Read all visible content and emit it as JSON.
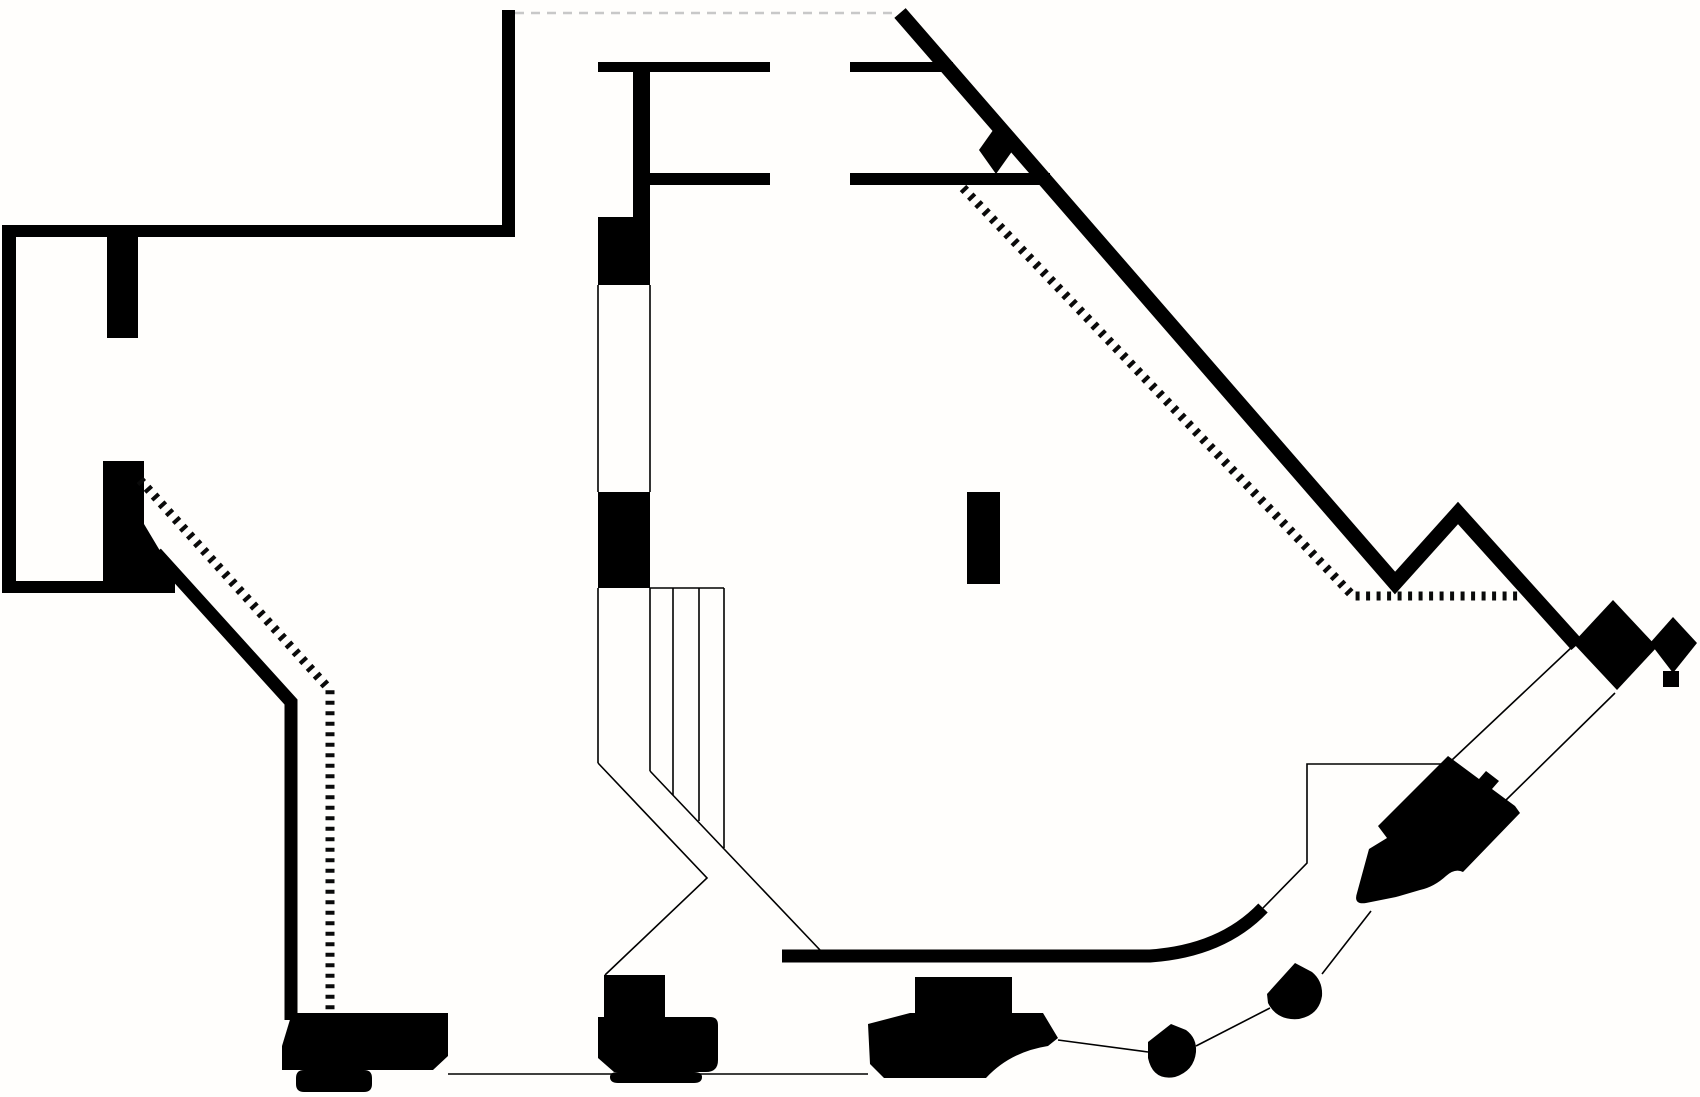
{
  "meta": {
    "title": "architectural-floor-plan",
    "canvas": {
      "width": 1700,
      "height": 1097
    },
    "colors": {
      "background": "#fffefc",
      "ink": "#000000",
      "dashed_gray": "#c8c8c8"
    }
  },
  "plan": {
    "groups": [
      {
        "name": "filled-walls-and-piers",
        "attrs": {
          "fill": "#000000",
          "stroke": "none"
        },
        "items": [
          {
            "name": "wall-top-vertical",
            "d": "M502,10 H515 V237 H502 Z"
          },
          {
            "name": "wall-upper-horizontal",
            "d": "M2,225 H515 V237 H2 Z"
          },
          {
            "name": "wall-left-vertical",
            "d": "M2,225 H16 V593 H2 Z"
          },
          {
            "name": "wall-lower-left-horizontal",
            "d": "M2,581 H175 V593 H2 Z"
          },
          {
            "name": "pier-upper-left",
            "d": "M107,237 H138 V338 H107 Z"
          },
          {
            "name": "pier-lower-left",
            "d": "M103,461 H144 V581 H103 Z"
          },
          {
            "name": "pier-lower-left-wedge",
            "d": "M144,524 L178,581 L144,581 Z"
          },
          {
            "name": "f-wall-stem",
            "d": "M633,62 H650 V217 H633 Z"
          },
          {
            "name": "f-wall-arm-top-left",
            "d": "M598,62 H770 V72 H598 Z"
          },
          {
            "name": "f-wall-arm-top-right",
            "d": "M850,62 H953 V72 H850 Z"
          },
          {
            "name": "f-wall-arm-mid-left",
            "d": "M633,173 H770 V185 H633 Z"
          },
          {
            "name": "f-wall-arm-mid-right",
            "d": "M850,173 H1050 V185 H850 Z"
          },
          {
            "name": "column-pier-upper",
            "d": "M598,217 H650 V285 H598 Z"
          },
          {
            "name": "column-pier-lower",
            "d": "M598,492 H650 V588 H598 Z"
          },
          {
            "name": "free-standing-column",
            "d": "M967,492 H1000 V584 H967 Z"
          },
          {
            "name": "diamond-on-diagonal-wall",
            "d": "M979,150 L996,126 L1013,150 L996,174 Z"
          },
          {
            "name": "cluster-large-diamond",
            "d": "M1573,643 L1613,600 L1657,647 L1617,690 Z"
          },
          {
            "name": "cluster-small-diamond",
            "d": "M1650,643 L1673,617 L1697,643 L1673,673 Z"
          },
          {
            "name": "cluster-foot-square",
            "d": "M1663,671 H1679 V687 H1663 Z"
          },
          {
            "name": "console-right-piano",
            "d": "M1448,756 L1479,779 L1486,771 L1499,781 L1492,789 L1515,806 L1520,813 L1463,872 Q1455,868 1446,876 Q1434,887 1420,890 L1396,897 L1366,903 Q1353,905 1357,893 L1369,849 L1387,838 L1378,826 L1401,803 Z"
          },
          {
            "name": "pier-bottom-2-block",
            "d": "M604,975 H665 V1017 H604 Z"
          },
          {
            "name": "console-bottom-left",
            "d": "M292,1013 L448,1013 L448,1056 L433,1070 L282,1070 L282,1046 Z"
          },
          {
            "name": "console-bottom-left-tab",
            "d": "M304,1070 H364 Q372,1070 372,1078 V1084 Q372,1092 364,1092 H304 Q296,1092 296,1084 V1078 Q296,1070 304,1070 Z"
          },
          {
            "name": "console-bottom-2",
            "d": "M598,1017 H710 Q718,1017 718,1025 V1060 Q718,1072 706,1072 H614 L598,1058 Z"
          },
          {
            "name": "console-bottom-2-tab",
            "d": "M618,1072 H694 Q702,1072 702,1077 Q702,1083 694,1083 H618 Q610,1083 610,1077 Q610,1072 618,1072 Z"
          },
          {
            "name": "pier-bottom-3-block",
            "d": "M915,977 H1012 V1013 H915 Z"
          },
          {
            "name": "console-bottom-3",
            "d": "M868,1024 L910,1013 H1043 L1058,1038 L1048,1046 Q1010,1052 986,1078 H884 L870,1064 Z"
          },
          {
            "name": "blob-stool-1",
            "d": "M1148,1042 L1171,1024 L1186,1030 Q1197,1038 1196,1052 Q1194,1071 1175,1077 Q1153,1081 1148,1058 Z"
          },
          {
            "name": "blob-stool-2",
            "d": "M1267,994 L1295,963 L1312,972 Q1323,981 1322,996 Q1319,1015 1299,1019 Q1277,1021 1268,1003 Z"
          }
        ]
      },
      {
        "name": "thick-stroke-walls",
        "attrs": {
          "fill": "none",
          "stroke": "#000000",
          "stroke-linecap": "butt",
          "stroke-linejoin": "miter"
        },
        "items": [
          {
            "name": "main-diagonal-wall",
            "d": "M900,13 L1395,583 L1458,513 L1577,645",
            "attrs": {
              "stroke-width": "15"
            }
          },
          {
            "name": "left-diagonal-wall",
            "d": "M156,553 L291,702 V1020",
            "attrs": {
              "stroke-width": "13"
            }
          },
          {
            "name": "bottom-curved-wall",
            "d": "M782,956 H1150 Q1222,951 1263,908",
            "attrs": {
              "stroke-width": "13"
            }
          }
        ]
      },
      {
        "name": "thin-lines",
        "attrs": {
          "fill": "none",
          "stroke": "#000000",
          "stroke-width": "1.6",
          "stroke-linecap": "butt"
        },
        "items": [
          {
            "name": "open-wall-line-left",
            "d": "M598,285 V492"
          },
          {
            "name": "open-wall-line-right",
            "d": "M650,285 V492"
          },
          {
            "name": "under-pier-line-left",
            "d": "M598,588 V763"
          },
          {
            "name": "under-pier-line-right",
            "d": "M650,588 V771"
          },
          {
            "name": "stair-top-edge",
            "d": "M650,588 H724"
          },
          {
            "name": "stair-riser-1",
            "d": "M673,588 V795"
          },
          {
            "name": "stair-riser-2",
            "d": "M699,588 V821"
          },
          {
            "name": "stair-riser-3",
            "d": "M724,588 V848"
          },
          {
            "name": "stair-diagonal-stringer",
            "d": "M650,771 L820,950"
          },
          {
            "name": "stair-return-line",
            "d": "M598,763 L707,878 L605,975"
          },
          {
            "name": "bottom-base-line",
            "d": "M448,1074 H868"
          },
          {
            "name": "link-console3-stool1",
            "d": "M1058,1040 L1148,1052"
          },
          {
            "name": "link-stool1-stool2",
            "d": "M1196,1046 L1270,1008"
          },
          {
            "name": "link-stool2-console",
            "d": "M1322,974 L1371,911"
          },
          {
            "name": "planter-outline",
            "d": "M1445,764 H1307 V863 L1263,908"
          },
          {
            "name": "cluster-stem-upper",
            "d": "M1573,646 L1452,760"
          },
          {
            "name": "cluster-stem-lower",
            "d": "M1615,693 L1505,801"
          }
        ]
      },
      {
        "name": "dotted-guide-lines",
        "attrs": {
          "fill": "none",
          "stroke": "#0a0a0a",
          "stroke-width": "9",
          "stroke-dasharray": "4 6.5",
          "stroke-linecap": "butt",
          "stroke-linejoin": "miter"
        },
        "items": [
          {
            "name": "dotted-guide-left",
            "d": "M140,480 L330,690 V1013"
          },
          {
            "name": "dotted-guide-right",
            "d": "M963,188 L1353,596 H1520"
          }
        ]
      },
      {
        "name": "dashed-overhead-line",
        "attrs": {
          "fill": "none",
          "stroke": "#c8c8c8",
          "stroke-width": "2.5",
          "stroke-dasharray": "9 7",
          "stroke-linecap": "butt"
        },
        "items": [
          {
            "name": "overhead-dashed-line",
            "d": "M515,13 H898"
          }
        ]
      }
    ]
  }
}
